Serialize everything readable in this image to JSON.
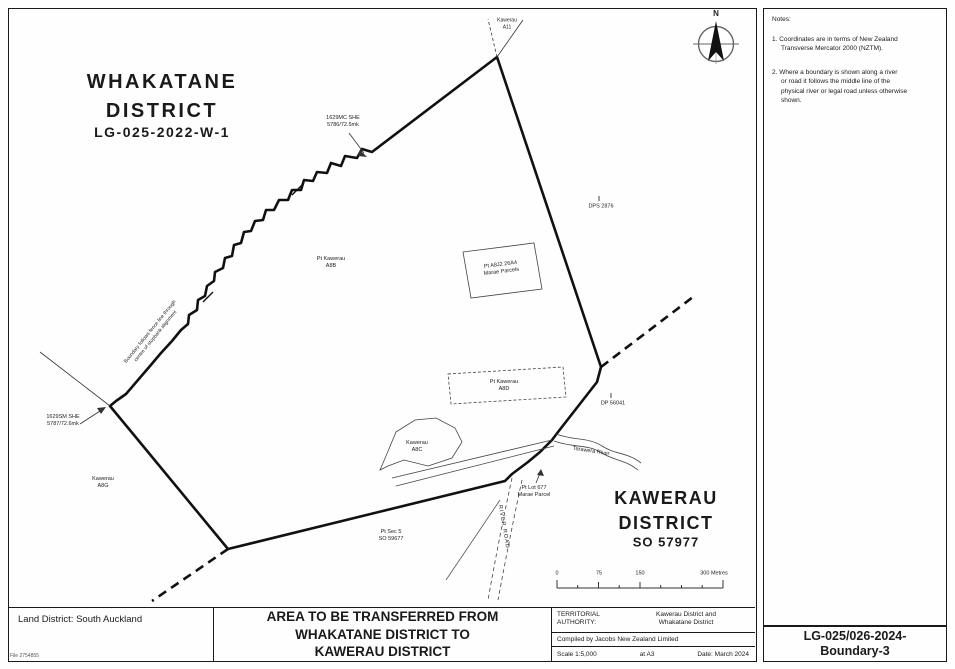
{
  "map": {
    "whakatane_title": "WHAKATANE\nDISTRICT",
    "whakatane_ref": "LG-025-2022-W-1",
    "kawerau_title": "KAWERAU\nDISTRICT",
    "kawerau_ref": "SO 57977",
    "north_label": "N",
    "labels": {
      "kawerau_a11": "Kawerau\nA11",
      "survey_mark_top": "1629MC SHE\n5786/72.5mk",
      "survey_mark_left": "1629SM SHE\n5787/72.6mk",
      "dps_2876": "DPS 2876",
      "dp_56041": "DP 56041",
      "pt_kawerau_a8b": "Pt Kawerau\nA8B",
      "marae_parcels_box": "Pt A8J2 26A4\nMarae Parcels",
      "pt_kawerau_a8d": "Pt Kawerau\nA8D",
      "kawerau_a8c": "Kawerau\nA8C",
      "pt_lot_677": "Pt Lot 677\nMarae Parcel",
      "kawerau_a8g": "Kawerau\nA8G",
      "pt_sec_5": "Pt Sec 5\nSO 59677",
      "tarawera_river": "Tarawera River",
      "road": "RIVER ROAD",
      "boundary_note": "Boundary follows fence line through\ncentre of stopbank alignment"
    },
    "scalebar": {
      "t0": "0",
      "t75": "75",
      "t150": "150",
      "t300": "300 Metres"
    }
  },
  "notes": {
    "title": "Notes:",
    "items": [
      "1. Coordinates are in terms of New Zealand\nTransverse Mercator 2000 (NZTM).",
      "2. Where a boundary is shown along a river\nor road it follows the middle line of the\nphysical river or legal road unless otherwise\nshown."
    ]
  },
  "sheet_ref": "LG-025/026-2024-\nBoundary-3",
  "title_block": {
    "land_district": "Land District: South Auckland",
    "main_title": "AREA TO BE TRANSFERRED FROM\nWHAKATANE DISTRICT TO\nKAWERAU DISTRICT",
    "territorial_authority_label": "TERRITORIAL\nAUTHORITY:",
    "territorial_authority_value": "Kawerau District and\nWhakatane District",
    "compiled_by": "Compiled by Jacobs New Zealand Limited",
    "scale": "Scale  1:5,000",
    "paper": "at A3",
    "date": "Date: March 2024",
    "file_ref": "File 2754855"
  },
  "colors": {
    "line": "#1a1a1a",
    "background": "#fefefe",
    "compass_ring": "#666666"
  }
}
